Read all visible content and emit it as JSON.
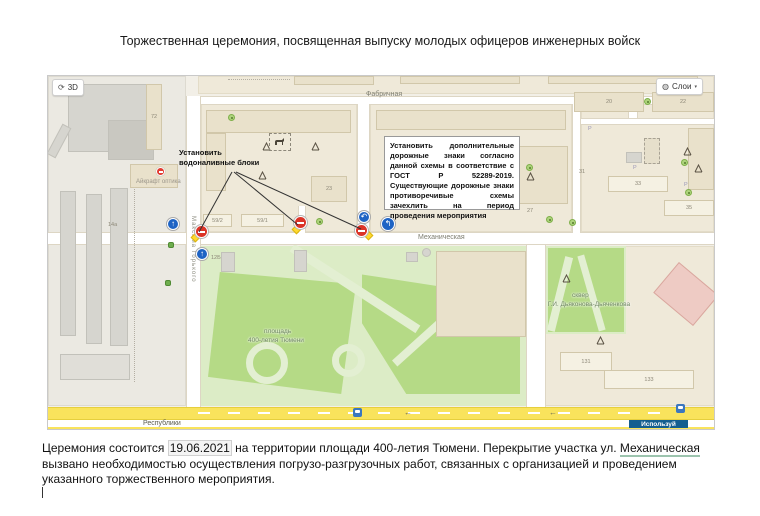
{
  "title": "Торжественная церемония, посвященная выпуску молодых офицеров инженерных войск",
  "map": {
    "controls": {
      "rotate": "3D",
      "layers": "Слои"
    },
    "icons": {
      "rotate_glyph": "⟳",
      "layers_glyph": "◍",
      "caret": "▾",
      "arrow_up": "↑",
      "turn_a": "↶",
      "turn_b": "↰",
      "arrow_left": "←",
      "parking": "Р"
    },
    "streets": {
      "fabrichnaya": "Фабричная",
      "mekhanicheskaya": "Механическая",
      "respubliki": "Республики",
      "gorkogo": "Максима Горького"
    },
    "areas": {
      "square1": "площадь",
      "square2": "400-летия Тюмени",
      "skver1": "сквер",
      "skver2": "им. Г.И. Дьяконова-Дьяченкова"
    },
    "poi": {
      "aikraft": "Айкрафт оптика"
    },
    "buildings": {
      "b72": "72",
      "b23": "23",
      "b59_2": "59/2",
      "b59_1": "59/1",
      "b14a": "14а",
      "b12b": "12Б",
      "b20": "20",
      "b22": "22",
      "b27": "27",
      "b31": "31",
      "b33": "33",
      "b35": "35",
      "b131": "131",
      "b133": "133"
    },
    "ad_badge": "Используй",
    "annotations": {
      "blocks1": "Установить",
      "blocks2": "водоналивные блоки",
      "note": "Установить дополнительные дорожные знаки согласно данной схемы в соответствие с ГОСТ Р 52289-2019. Существующие дорожные знаки противоречивые схемы зачехлить на период проведения мероприятия"
    },
    "colors": {
      "no_entry_red": "#db3327",
      "sign_blue": "#1e63c4",
      "road_yellow": "#f9e35c",
      "lawn_green": "#b5da86",
      "badge_blue": "#145e90"
    }
  },
  "paragraph": {
    "part1": "Церемония состоится ",
    "date": "19.06.2021",
    "part2": " на территории площади 400-летия Тюмени. Перекрытие участка ул. ",
    "street": "Механическая",
    "line2": "вызвано необходимостью осуществления погрузо-разгрузочных работ, связанных с организацией и проведением",
    "line3": "указанного торжественного мероприятия."
  }
}
